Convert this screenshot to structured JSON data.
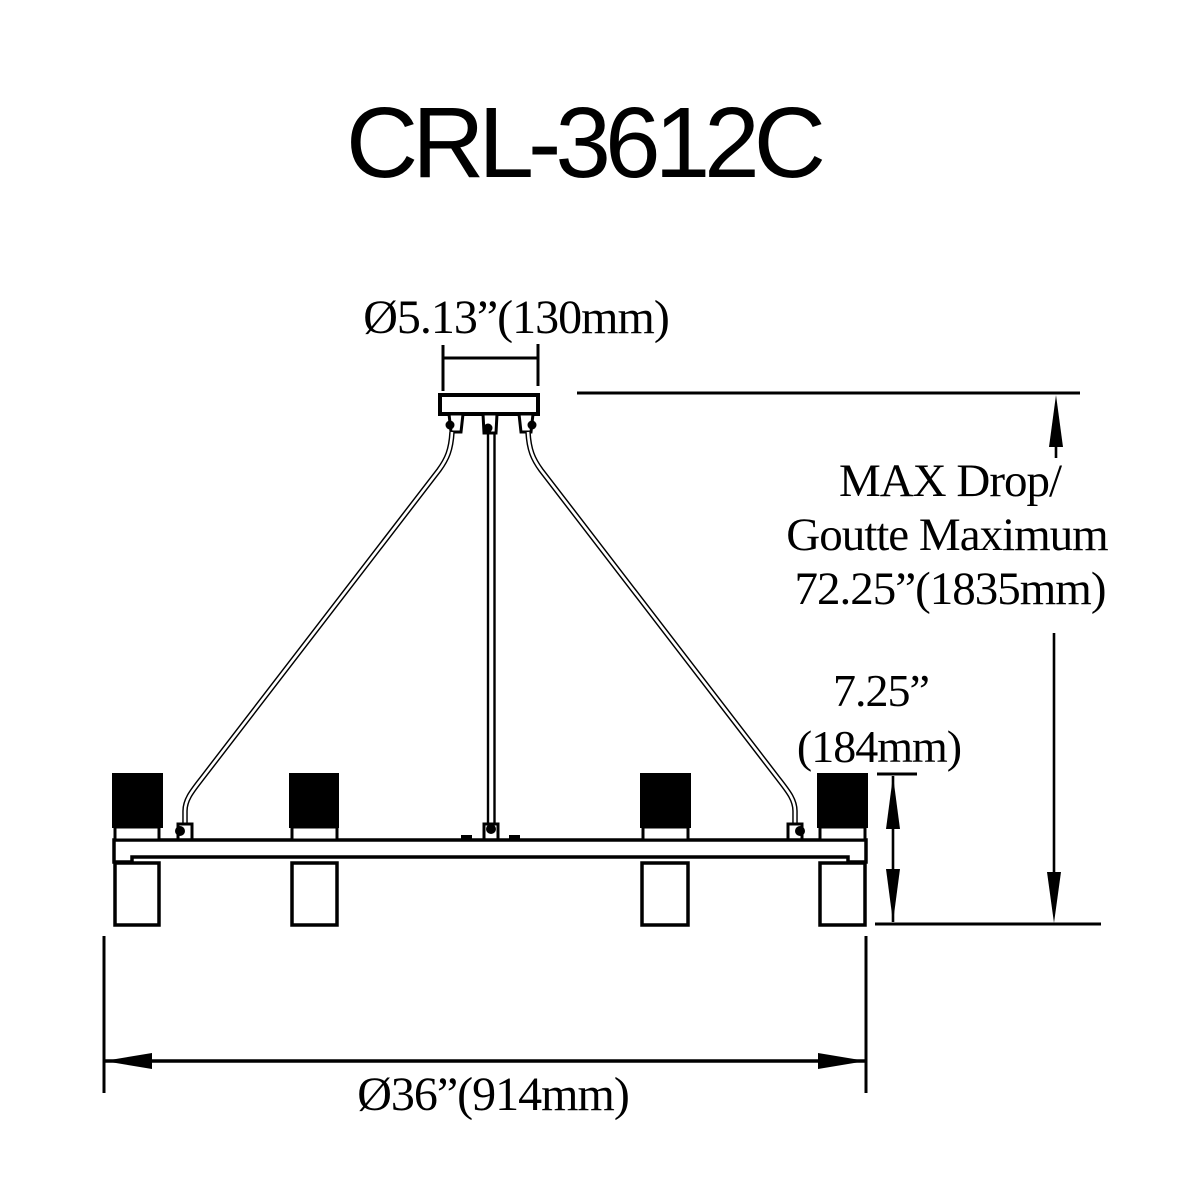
{
  "page": {
    "background": "#ffffff",
    "line_color": "#000000"
  },
  "title": "CRL-3612C",
  "dimensions": {
    "canopy_diameter": "Ø5.13”(130mm)",
    "max_drop": {
      "line1": "MAX Drop/",
      "line2": "Goutte Maximum",
      "line3": "72.25”(1835mm)"
    },
    "fixture_height": {
      "line1": "7.25”",
      "line2": "(184mm)"
    },
    "fixture_diameter": "Ø36”(914mm)"
  }
}
